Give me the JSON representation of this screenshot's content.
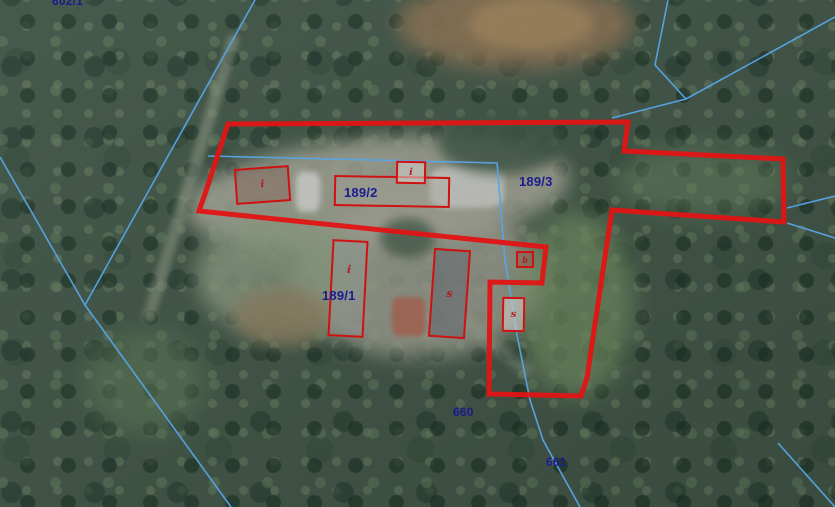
{
  "map": {
    "parcel_labels": {
      "p602": "602/1",
      "p189_1": "189/1",
      "p189_2": "189/2",
      "p189_3": "189/3",
      "p660": "660",
      "p661": "661"
    },
    "building_marks": {
      "b1": "i",
      "b3": "i",
      "b4": "b",
      "b5": "i",
      "b6": "s",
      "b7": "s"
    },
    "colors": {
      "selection_red": "#e11414",
      "building_outline_red": "#cf1111",
      "parcel_line_blue": "#58a5e8",
      "label_navy": "#1b1b8e"
    }
  }
}
